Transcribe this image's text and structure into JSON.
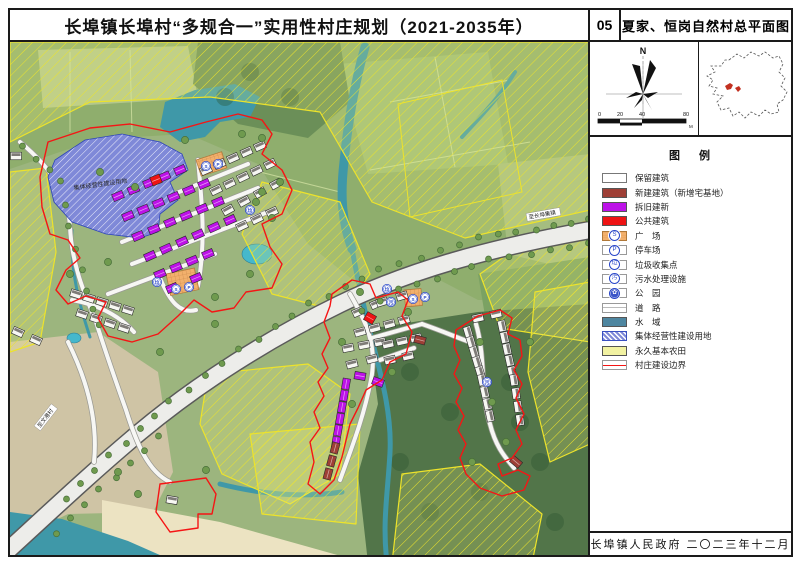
{
  "header": {
    "main_title": "长埠镇长埠村“多规合一”实用性村庄规划（2021-2035年）",
    "sheet_number": "05",
    "sheet_title": "夏家、恒岗自然村总平面图"
  },
  "compass": {
    "north_label": "N"
  },
  "scale_bar": {
    "ticks": [
      "0",
      "20",
      "40",
      "80"
    ],
    "unit": "M"
  },
  "legend": {
    "title": "图  例",
    "items": [
      {
        "label": "保留建筑",
        "swatch": "retain"
      },
      {
        "label": "新建建筑（新增宅基地）",
        "swatch": "solid",
        "color": "#9e3f36"
      },
      {
        "label": "拆旧建新",
        "swatch": "solid",
        "color": "#bd12e8"
      },
      {
        "label": "公共建筑",
        "swatch": "solid",
        "color": "#ee1313"
      },
      {
        "label": "广　场",
        "swatch": "plaza",
        "glyph": "S"
      },
      {
        "label": "停车场",
        "swatch": "icon",
        "glyph": "P"
      },
      {
        "label": "垃圾收集点",
        "swatch": "icon",
        "glyph": "垃"
      },
      {
        "label": "污水处理设施",
        "swatch": "icon",
        "glyph": "污"
      },
      {
        "label": "公　园",
        "swatch": "icon-fill",
        "glyph": "✿"
      },
      {
        "label": "道　路",
        "swatch": "road"
      },
      {
        "label": "水　域",
        "swatch": "solid",
        "color": "#4e86a0"
      },
      {
        "label": "集体经营性建设用地",
        "swatch": "collective",
        "color": "#7f89d8"
      },
      {
        "label": "永久基本农田",
        "swatch": "solid",
        "color": "#f2f2a2"
      },
      {
        "label": "村庄建设边界",
        "swatch": "boundary",
        "color": "#f51515"
      }
    ]
  },
  "footer": {
    "text": "长埠镇人民政府  二〇二三年十二月"
  },
  "map": {
    "colors": {
      "base": "#9cb57e",
      "fieldA": "#8fae6d",
      "fieldLight": "#b3c78c",
      "fieldMid": "#9cbb77",
      "fieldR": "#a5bd80",
      "forestTop": "#6b8f58",
      "forestBR": "#527549",
      "rightMid": "#7ba263",
      "tan": "#cfc4a5",
      "sand": "#ece3c2",
      "water": "#3f98a8",
      "pond": "#45b8cc",
      "roadFill": "#ededea",
      "roadCase": "#5a5a5a",
      "laneFill": "#f7f7f4",
      "laneCase": "#9a9a94",
      "hatchLine": "#ede32b",
      "collective": "#7f89d8",
      "collectiveLine": "#2f46b8",
      "boundary": "#f51515",
      "retain": "#f7f7f3",
      "retainRoof": "#55524e",
      "rebuild": "#bd12e8",
      "public": "#ee1313",
      "newres": "#9e3f36",
      "tree": "#6f9a4e",
      "treeEdge": "#49703a",
      "orange": "#f2b06c",
      "icon": "#2846c8"
    },
    "patches": [
      [
        "fieldA",
        "0,0 580,0 580,258 468,258 418,232 348,242 298,202 248,122 178,92 88,97 0,127"
      ],
      [
        "fieldLight",
        "28,8 178,4 188,56 33,66"
      ],
      [
        "fieldMid",
        "328,22 478,10 498,122 358,132"
      ],
      [
        "fieldR",
        "488,122 580,112 580,232 498,212"
      ],
      [
        "forestTop",
        "188,0 330,0 340,60 298,96 228,82 183,42"
      ],
      [
        "rightMid",
        "468,232 580,215 580,302 478,292"
      ],
      [
        "forestBR",
        "358,287 468,270 580,262 580,521 358,521 348,432 368,362"
      ],
      [
        "tan",
        "0,300 88,290 148,330 163,430 143,470 58,472 0,500"
      ],
      [
        "sand",
        "92,458 210,480 338,516 345,521 92,521"
      ],
      [
        "water",
        "0,470 52,477 118,499 168,521 0,521"
      ],
      [
        "water",
        "155,60 185,48 225,42 250,55 240,75 210,80 195,95 170,100 150,85"
      ]
    ],
    "parcel_lines": [
      "M380,60 L500,38",
      "M360,128 L520,100",
      "M425,15 L445,125",
      "M60,10 L60,90",
      "M120,8 L122,90",
      "M250,130 L330,150"
    ],
    "water_paths": [
      [
        "M355,5 C345,40 338,80 334,120 C330,155 332,180 342,207",
        9
      ],
      [
        "M342,207 C348,240 354,265 360,290 C370,330 382,370 380,410 C378,450 372,480 377,521",
        5
      ],
      [
        "M505,30 C490,55 470,75 452,95",
        4
      ],
      [
        "M210,442 C250,452 292,456 332,450",
        5
      ],
      [
        "M62,188 C60,230 70,265 80,295",
        3
      ]
    ],
    "ponds": [
      [
        247,
        212,
        15,
        10
      ],
      [
        64,
        296,
        7,
        5
      ]
    ],
    "hatch_polys": [
      "0,0 580,0 580,168 455,196 362,160 310,70 200,55 80,60 0,100",
      "580,178 580,300 490,286 470,232 520,196",
      "252,140 330,160 360,232 332,270 262,252 232,192",
      "198,332 298,322 340,352 330,432 280,462 212,432 190,382",
      "240,392 350,382 346,482 252,472",
      "392,432 470,422 532,472 522,521 382,521",
      "525,250 580,240 580,402 540,420 518,330",
      "0,130 36,126 46,210 30,300 0,310"
    ],
    "parcel_outline": "388,62 492,38 512,150 400,175",
    "main_road": "M580,188 C480,206 400,228 330,262 C260,296 190,340 130,390 C80,432 40,470 -6,512",
    "lanes": [
      "M10,100 C40,125 58,150 60,185 C62,225 76,255 86,280 C94,305 106,340 116,368 C126,400 138,430 160,440",
      "M100,178 L238,122",
      "M112,200 L248,146",
      "M122,222 L258,170",
      "M98,252 L205,212",
      "M188,118 C192,160 196,200 188,244",
      "M150,236 C160,260 170,272 186,268",
      "M62,258 C85,262 108,272 124,290",
      "M340,252 C356,280 366,300 362,332 C356,368 344,400 330,438",
      "M362,296 L412,282",
      "M370,318 L404,306",
      "M412,282 C435,290 448,296 460,300",
      "M466,282 C476,316 470,350 480,382 C486,406 496,416 504,426",
      "M58,300 C78,340 88,380 84,420"
    ],
    "collective": {
      "points": "45,118 75,98 112,92 150,100 172,112 178,128 160,140 168,158 150,172 148,190 130,196 96,192 62,180 44,160 38,135",
      "label": "集体经营性建设用地",
      "lx": 64,
      "ly": 148,
      "rot": -8
    },
    "plazas": [
      [
        186,
        118,
        27,
        17,
        -18
      ],
      [
        156,
        232,
        29,
        22,
        -12
      ],
      [
        394,
        248,
        17,
        17,
        -5
      ]
    ],
    "building_rows": [
      [
        "rebuild",
        108,
        154,
        170,
        128,
        5
      ],
      [
        "rebuild",
        118,
        174,
        194,
        142,
        6
      ],
      [
        "rebuild",
        128,
        194,
        208,
        160,
        6
      ],
      [
        "rebuild",
        140,
        214,
        220,
        178,
        6
      ],
      [
        "rebuild",
        150,
        232,
        198,
        212,
        4
      ],
      [
        "rebuild",
        162,
        246,
        186,
        236,
        2
      ],
      [
        "retain",
        196,
        128,
        250,
        104,
        5
      ],
      [
        "retain",
        206,
        148,
        260,
        122,
        5
      ],
      [
        "retain",
        218,
        168,
        266,
        142,
        4
      ],
      [
        "retain",
        232,
        184,
        262,
        170,
        3
      ],
      [
        "retain",
        66,
        252,
        118,
        268,
        5
      ],
      [
        "retain",
        72,
        272,
        114,
        286,
        4
      ],
      [
        "retain",
        8,
        290,
        26,
        298,
        2
      ],
      [
        "retain",
        6,
        114,
        6,
        114,
        1,
        0
      ],
      [
        "public",
        146,
        138,
        146,
        138,
        1,
        -22
      ],
      [
        "retain",
        348,
        270,
        366,
        262,
        2
      ],
      [
        "retain",
        372,
        260,
        392,
        254,
        2
      ],
      [
        "retain",
        350,
        290,
        394,
        278,
        4
      ],
      [
        "retain",
        338,
        306,
        370,
        300,
        3
      ],
      [
        "retain",
        378,
        302,
        406,
        296,
        3
      ],
      [
        "retain",
        342,
        322,
        362,
        317,
        2
      ],
      [
        "retain",
        380,
        318,
        398,
        314,
        2
      ],
      [
        "rebuild",
        350,
        334,
        350,
        334,
        1,
        10
      ],
      [
        "rebuild",
        368,
        340,
        368,
        340,
        1,
        20
      ],
      [
        "public",
        360,
        276,
        360,
        276,
        1,
        30
      ],
      [
        "newres",
        410,
        298,
        410,
        298,
        1,
        15
      ],
      [
        "rebuild",
        336,
        342,
        326,
        400,
        6
      ],
      [
        "newres",
        325,
        406,
        318,
        432,
        3
      ],
      [
        "retain",
        458,
        290,
        470,
        330,
        5
      ],
      [
        "retain",
        472,
        338,
        480,
        374,
        4
      ],
      [
        "retain",
        492,
        284,
        502,
        330,
        5
      ],
      [
        "retain",
        504,
        338,
        510,
        378,
        4
      ],
      [
        "retain",
        468,
        276,
        486,
        272,
        2
      ],
      [
        "newres",
        506,
        420,
        506,
        420,
        1,
        40
      ],
      [
        "retain",
        162,
        458,
        162,
        458,
        1,
        10
      ]
    ],
    "tree_lines": [
      [
        [
          580,
          178
        ],
        [
          470,
          196
        ],
        [
          370,
          228
        ],
        [
          300,
          262
        ],
        [
          230,
          308
        ],
        [
          160,
          360
        ],
        [
          100,
          414
        ],
        [
          40,
          470
        ]
      ],
      [
        [
          580,
          202
        ],
        [
          480,
          218
        ],
        [
          390,
          248
        ],
        [
          332,
          280
        ]
      ],
      [
        [
          150,
          395
        ],
        [
          90,
          448
        ],
        [
          30,
          505
        ]
      ],
      [
        [
          14,
          105
        ],
        [
          52,
          140
        ],
        [
          60,
          185
        ],
        [
          78,
          250
        ],
        [
          94,
          300
        ]
      ]
    ],
    "tree_clusters": [
      [
        90,
        130
      ],
      [
        175,
        98
      ],
      [
        232,
        92
      ],
      [
        252,
        150
      ],
      [
        262,
        176
      ],
      [
        240,
        232
      ],
      [
        150,
        310
      ],
      [
        205,
        282
      ],
      [
        60,
        232
      ],
      [
        252,
        96
      ],
      [
        270,
        140
      ],
      [
        246,
        160
      ],
      [
        350,
        250
      ],
      [
        398,
        270
      ],
      [
        382,
        330
      ],
      [
        342,
        362
      ],
      [
        332,
        300
      ],
      [
        470,
        300
      ],
      [
        482,
        360
      ],
      [
        496,
        400
      ],
      [
        462,
        420
      ],
      [
        520,
        300
      ],
      [
        205,
        255
      ],
      [
        125,
        145
      ],
      [
        98,
        220
      ],
      [
        128,
        452
      ],
      [
        108,
        430
      ],
      [
        196,
        428
      ]
    ],
    "boundaries": [
      "38,100 80,86 120,82 160,90 196,80 228,72 252,78 262,92 252,112 272,128 282,148 272,172 252,182 260,205 272,222 262,246 236,250 224,266 202,270 184,258 168,274 148,292 122,300 98,294 88,276 96,260 76,254 58,262 46,248 56,228 70,216 58,198 40,192 32,165 30,135",
      "322,252 342,238 360,242 366,256 388,250 398,258 392,274 402,290 396,312 380,320 372,338 356,348 348,366 340,382 332,415 324,438 310,452 298,442 304,420 300,400 310,386 304,370 314,354 308,340 318,326 312,312 320,296 314,280 320,264",
      "446,288 468,274 490,268 502,276 498,292 510,298 512,314 504,328 512,342 506,356 514,372 506,388 512,402 502,416 488,422 492,434 508,428 520,434 514,448 492,454 470,446 456,432 450,416 456,402 448,388 454,374 446,360 452,346 444,332 450,318 444,304",
      "150,442 196,436 206,452 202,472 188,472 188,486 160,490 146,470"
    ],
    "icons": [
      [
        "S",
        196,
        124
      ],
      [
        "P",
        208,
        122
      ],
      [
        "la",
        240,
        168
      ],
      [
        "la",
        147,
        240
      ],
      [
        "S",
        166,
        247
      ],
      [
        "P",
        179,
        245
      ],
      [
        "la",
        377,
        247
      ],
      [
        "wu",
        381,
        260
      ],
      [
        "S",
        403,
        257
      ],
      [
        "P",
        415,
        255
      ],
      [
        "wu",
        477,
        340
      ]
    ],
    "icon_glyphs": {
      "S": "S",
      "P": "P",
      "la": "垃",
      "wu": "污"
    },
    "labels": [
      {
        "text": "至长埠集镇",
        "x": 519,
        "y": 177,
        "rot": -10,
        "bg": true
      },
      {
        "text": "至文港村",
        "x": 30,
        "y": 386,
        "rot": -52,
        "bg": true
      }
    ]
  }
}
